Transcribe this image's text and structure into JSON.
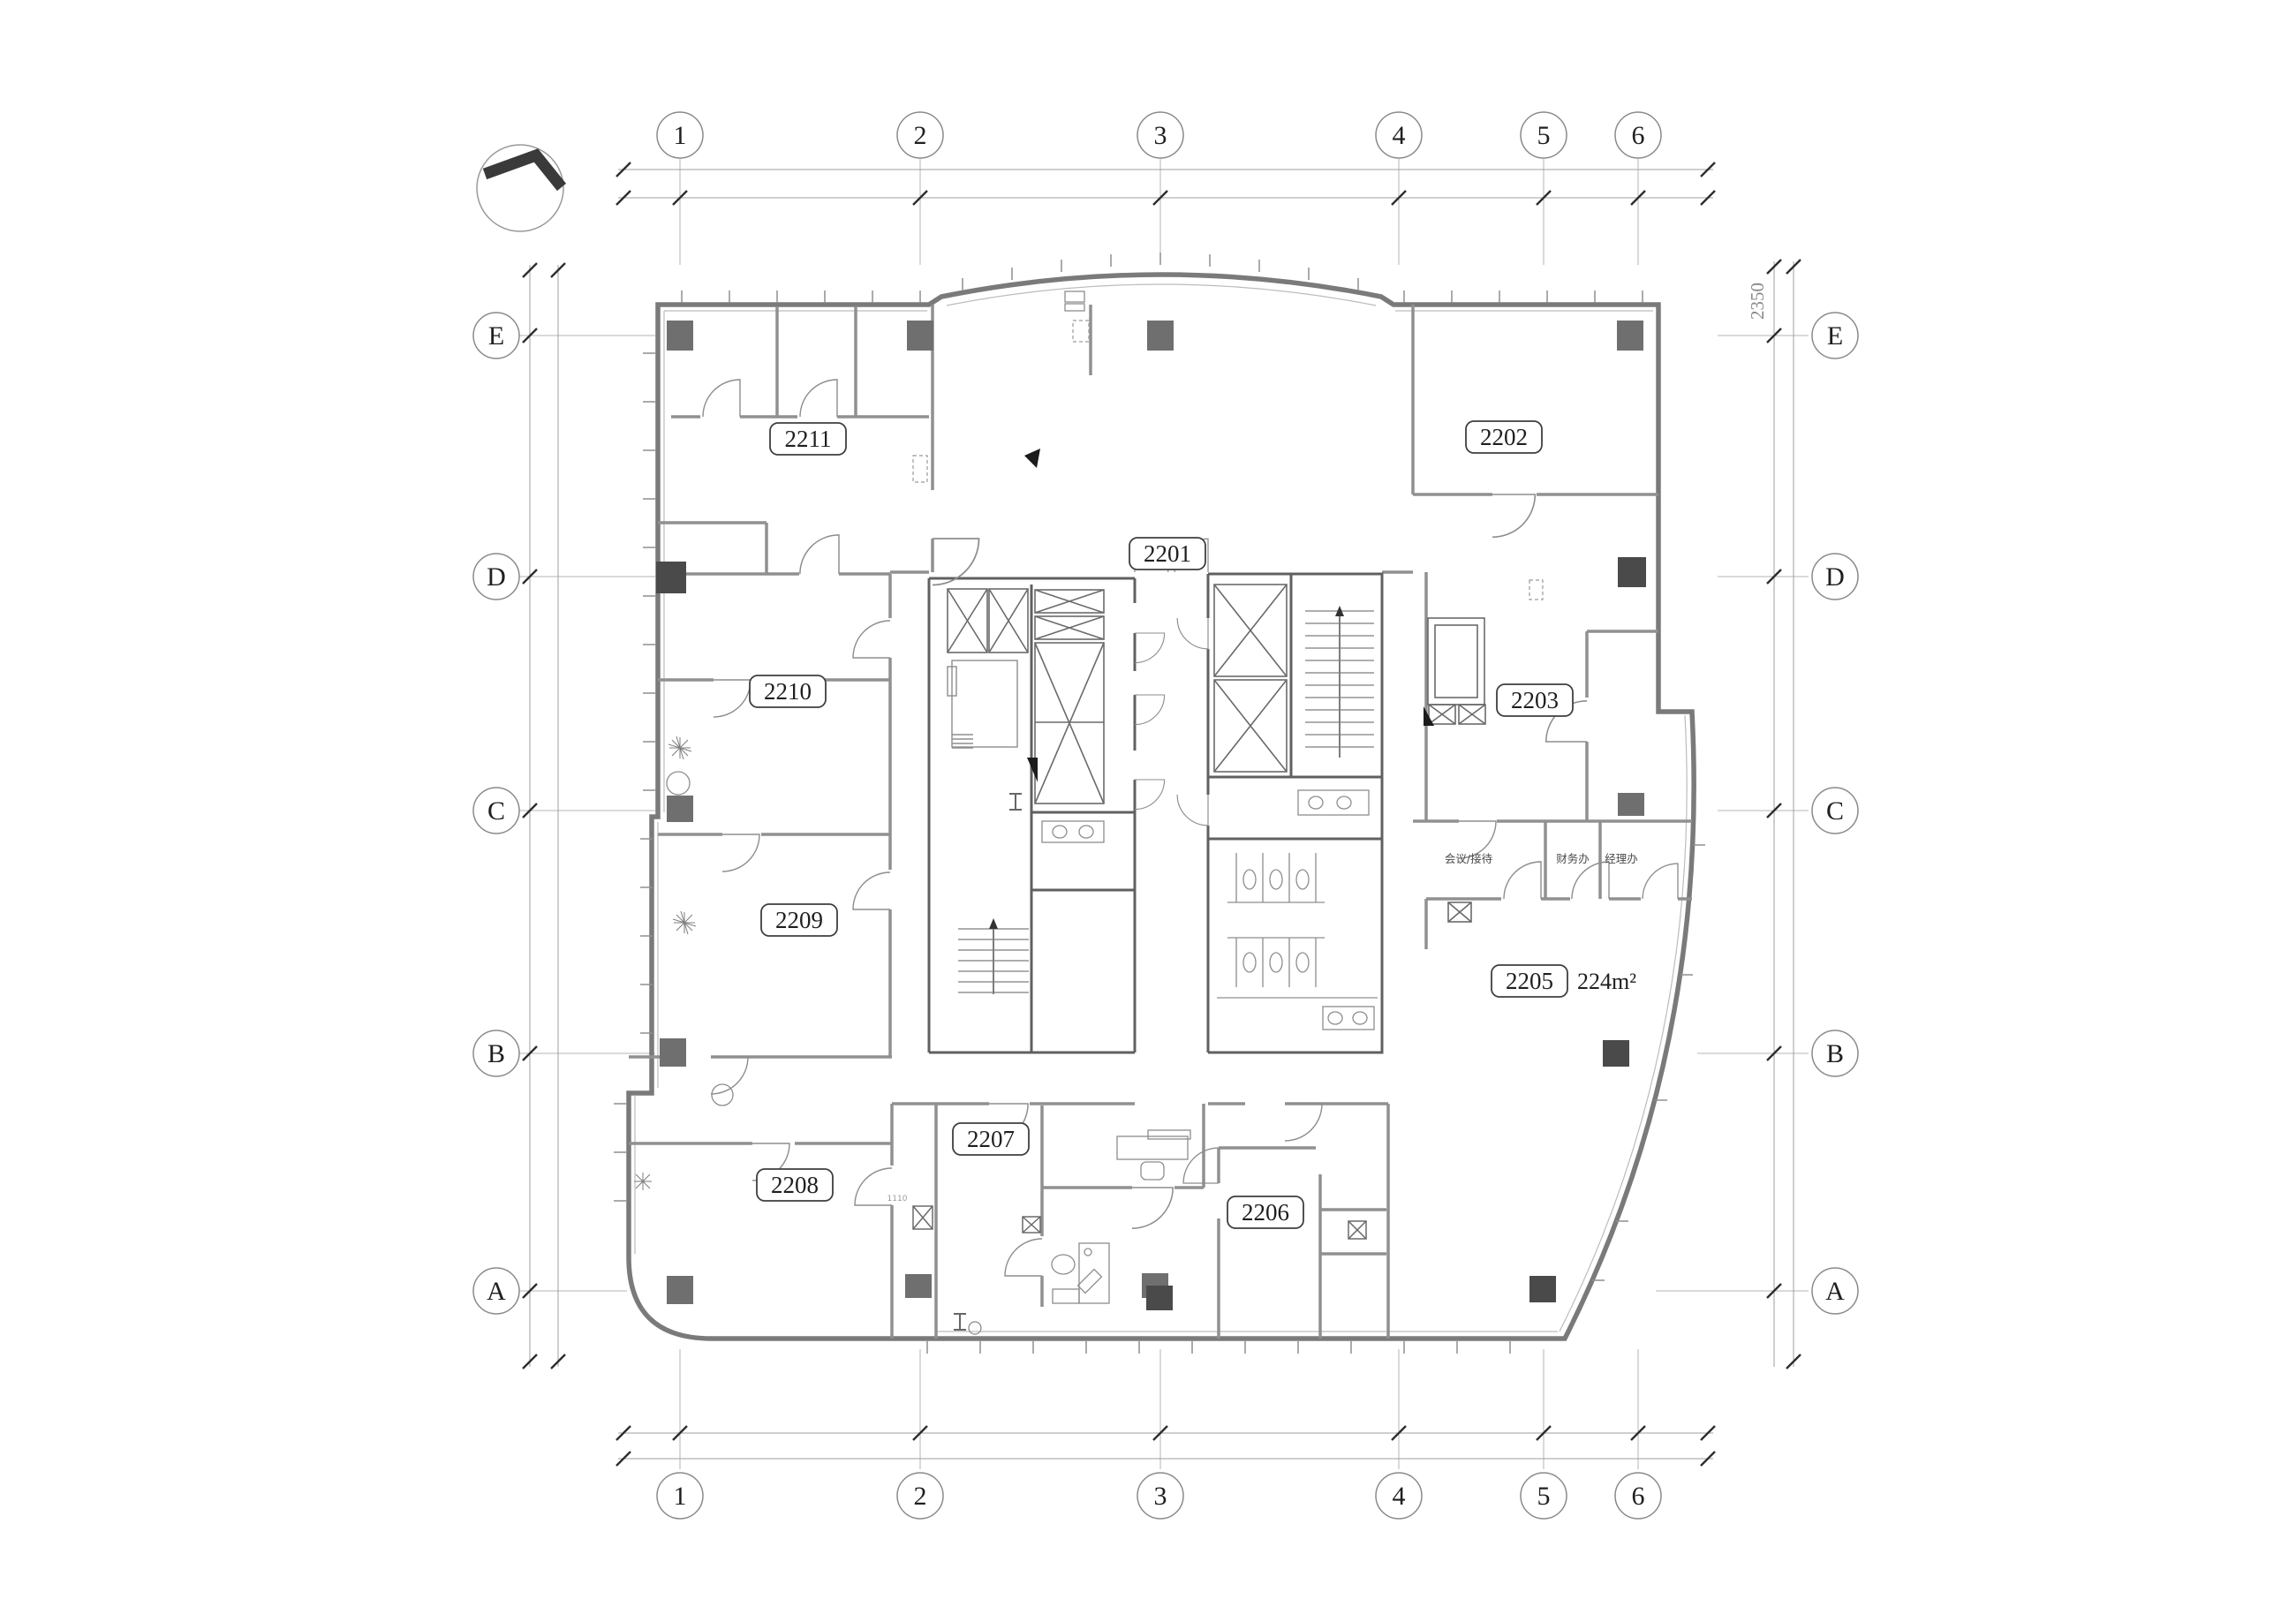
{
  "plan": {
    "grid": {
      "columns": [
        "1",
        "2",
        "3",
        "4",
        "5",
        "6"
      ],
      "rows": [
        "E",
        "D",
        "C",
        "B",
        "A"
      ]
    },
    "rooms": {
      "2201": "2201",
      "2202": "2202",
      "2203": "2203",
      "2205": "2205",
      "2206": "2206",
      "2207": "2207",
      "2208": "2208",
      "2209": "2209",
      "2210": "2210",
      "2211": "2211"
    },
    "room_2205_area": "224m²",
    "offices": [
      "会议/接待",
      "财务办",
      "经理办"
    ],
    "dimensions": {
      "right_top": "2350"
    },
    "door_tag": "1110",
    "colors": {
      "outer_wall": "#7a7a7a",
      "partition": "#909090",
      "core_wall": "#606060",
      "column": "#6f6f6f",
      "column_dark": "#4a4a4a",
      "grid_line": "#b5b5b5",
      "dim_tick": "#2e2e2e",
      "label_text": "#1f1f1f"
    }
  }
}
